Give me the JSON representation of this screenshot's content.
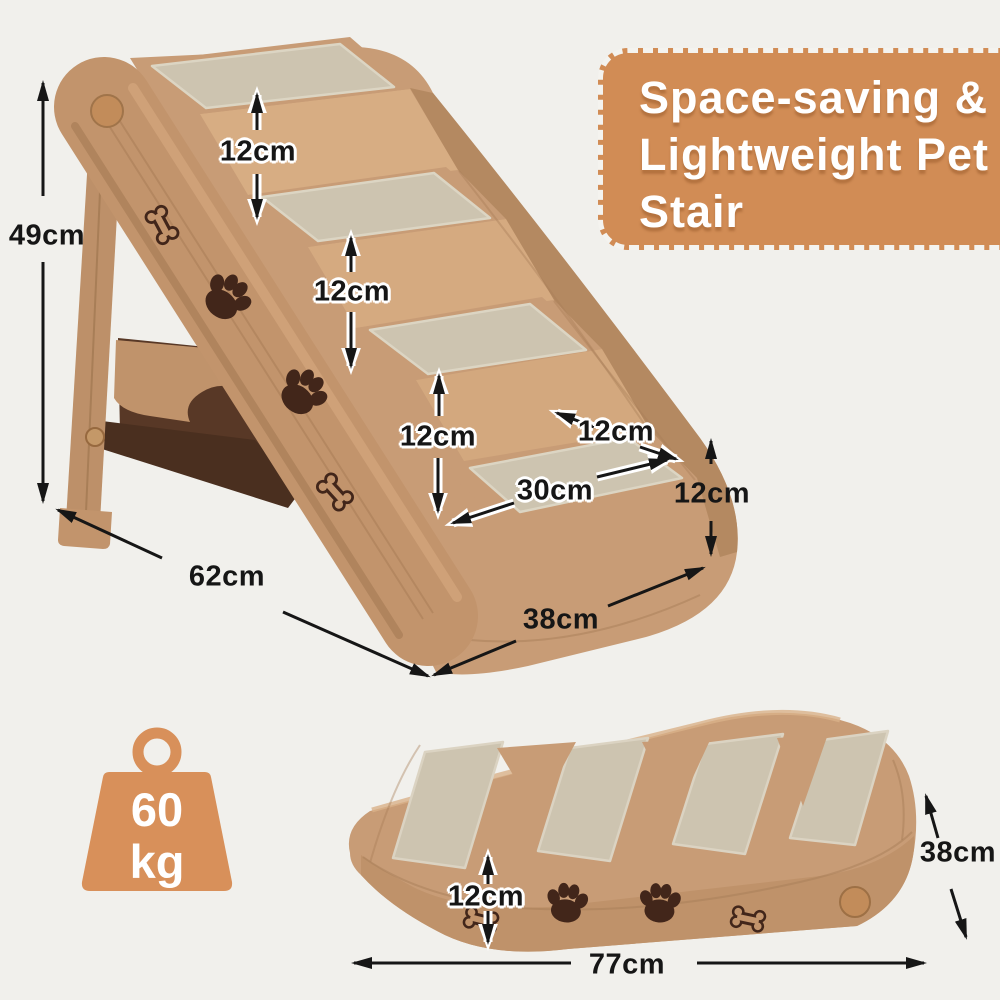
{
  "badge": {
    "line1": "Space-saving &",
    "line2": "Lightweight Pet",
    "line3": "Stair",
    "bg_color": "#d18c55",
    "text_color": "#ffffff"
  },
  "weight": {
    "value": "60",
    "unit": "kg",
    "color": "#d8905a"
  },
  "unfolded": {
    "total_height": "49cm",
    "top_step_rise": "12cm",
    "middle_step_rise": "12cm",
    "bottom_step_rise": "12cm",
    "step_width": "30cm",
    "step_depth": "12cm",
    "base_height": "12cm",
    "base_depth": "62cm",
    "base_width": "38cm"
  },
  "folded": {
    "thickness": "12cm",
    "length": "77cm",
    "width": "38cm"
  },
  "product": {
    "body_color": "#c89c76",
    "carpet_color": "#cdc4b0",
    "print_color": "#42261a"
  },
  "icons": {
    "weight": "weight-icon",
    "paw": "paw-icon",
    "bone": "bone-icon",
    "knob": "knob-icon"
  }
}
